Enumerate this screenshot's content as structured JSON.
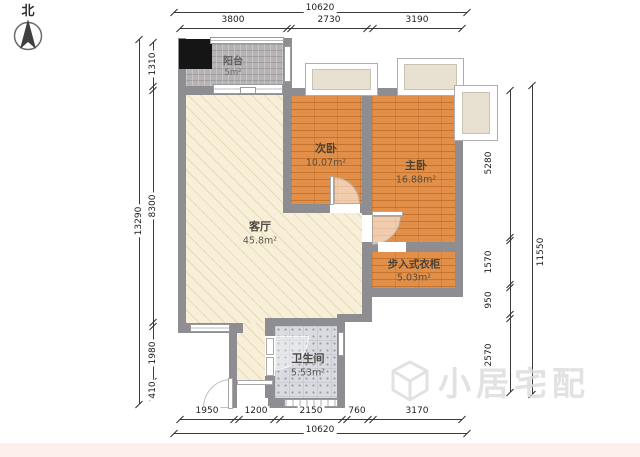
{
  "compass": {
    "label": "北"
  },
  "rooms": {
    "balcony": {
      "name": "阳台",
      "area": "5m²"
    },
    "second_bedroom": {
      "name": "次卧",
      "area": "10.07m²"
    },
    "master_bedroom": {
      "name": "主卧",
      "area": "16.88m²"
    },
    "living_room": {
      "name": "客厅",
      "area": "45.8m²"
    },
    "walk_in_closet": {
      "name": "步入式衣柜",
      "area": "5.03m²"
    },
    "bathroom": {
      "name": "卫生间",
      "area": "5.53m²"
    }
  },
  "dims": {
    "top": {
      "total": "10620",
      "segments": [
        "3800",
        "2730",
        "3190"
      ]
    },
    "bottom": {
      "total": "10620",
      "segments": [
        "1950",
        "1200",
        "2150",
        "760",
        "3170"
      ]
    },
    "left": {
      "total": "13290",
      "segments": [
        "1310",
        "8300",
        "1980",
        "410"
      ]
    },
    "right": {
      "total": "11550",
      "segments": [
        "5280",
        "1570",
        "950",
        "2570"
      ]
    }
  },
  "watermark": {
    "text": "小居宅配"
  },
  "colors": {
    "wall": "#8e8d92",
    "wood_floor": "#dd8a42",
    "living_floor": "#f7efd8",
    "balcony_floor": "#b7b3b4",
    "bathroom_floor": "#d9dbe0",
    "bay_window_fill": "#e8e1d1",
    "shaft_black": "#151515",
    "dimension_line": "#3a3a3a",
    "watermark_gray": "#dcdcdc",
    "footer_strip": "#fdf0ea"
  }
}
